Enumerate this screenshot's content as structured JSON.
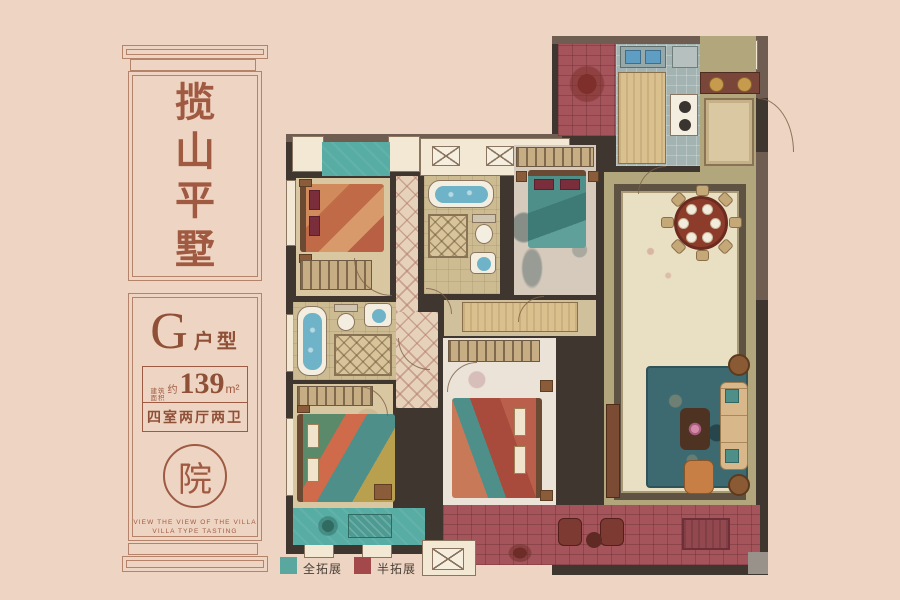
{
  "sidebar": {
    "title_chars": [
      "揽",
      "山",
      "平",
      "墅"
    ],
    "unit": {
      "letter": "G",
      "label": "户型"
    },
    "area": {
      "prefix_line1": "建筑",
      "prefix_line2": "面积",
      "approx": "约",
      "value": "139",
      "unit": "m²"
    },
    "rooms_spec": "四室两厅两卫",
    "seal_char": "院",
    "caption_line1": "VIEW THE VIEW OF THE VILLA",
    "caption_line2": "VILLA TYPE TASTING"
  },
  "legend": {
    "items": [
      {
        "label": "全拓展",
        "color": "#5aa79f"
      },
      {
        "label": "半拓展",
        "color": "#a3494b"
      }
    ]
  },
  "palette": {
    "background": "#eed4c2",
    "accent_brown": "#9e5a42",
    "wall_dark": "#3f362f",
    "teal_expand": "#57aca4",
    "maroon_expand": "#a4545a"
  }
}
